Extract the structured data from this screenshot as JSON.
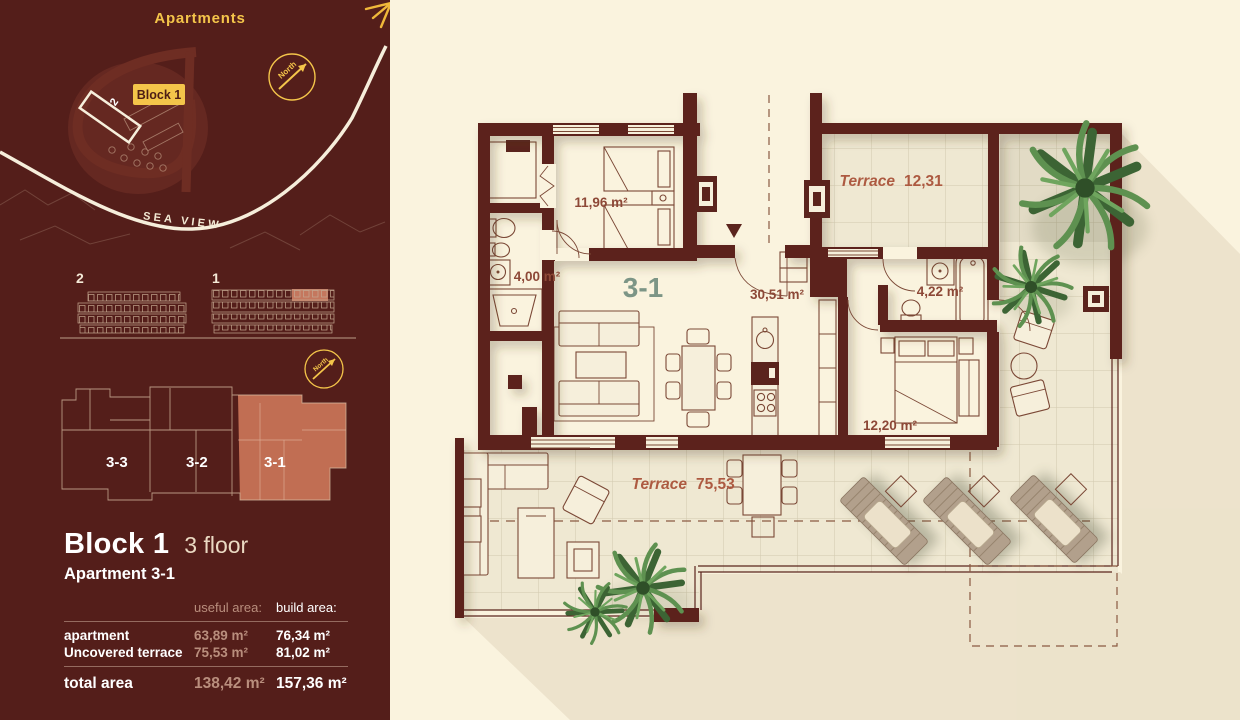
{
  "sidebar": {
    "site_map": {
      "title": "Apartments",
      "block_badge": "Block 1",
      "building_label": "2",
      "north_label": "North",
      "sea_view_label": "SEA VIEW"
    },
    "elevations": {
      "building_left_label": "2",
      "building_right_label": "1",
      "north_label": "North"
    },
    "floor_overview": {
      "units": [
        {
          "label": "3-3"
        },
        {
          "label": "3-2"
        },
        {
          "label": "3-1"
        }
      ]
    },
    "summary": {
      "block_title": "Block 1",
      "floor_label": "3 floor",
      "apartment_label": "Apartment 3-1",
      "col_useful": "useful area:",
      "col_build": "build area:",
      "rows": [
        {
          "label": "apartment",
          "useful": "63,89 m²",
          "build": "76,34 m²"
        },
        {
          "label": "Uncovered terrace",
          "useful": "75,53 m²",
          "build": "81,02 m²"
        }
      ],
      "total": {
        "label": "total area",
        "useful": "138,42 m²",
        "build": "157,36 m²"
      }
    }
  },
  "plan": {
    "apartment_label": "3-1",
    "rooms": [
      {
        "name": "bedroom-1",
        "area": "11,96 m²"
      },
      {
        "name": "bathroom-1",
        "area": "4,00 m²"
      },
      {
        "name": "living-hall",
        "area": "30,51 m²"
      },
      {
        "name": "bathroom-2",
        "area": "4,22 m²"
      },
      {
        "name": "bedroom-2",
        "area": "12,20 m²"
      }
    ],
    "terraces": [
      {
        "name": "terrace-upper",
        "label": "Terrace",
        "area": "12,31"
      },
      {
        "name": "terrace-main",
        "label": "Terrace",
        "area": "75,53"
      }
    ]
  },
  "colors": {
    "sidebar_bg": "#541e1a",
    "wall": "#5b241d",
    "cream": "#faf3de",
    "accent_yellow": "#f4c54a",
    "salmon_highlight": "#d07a5b",
    "room_label": "#8d4837",
    "terrace_label": "#ad5a41",
    "apartment_number_green": "#7c9586"
  }
}
